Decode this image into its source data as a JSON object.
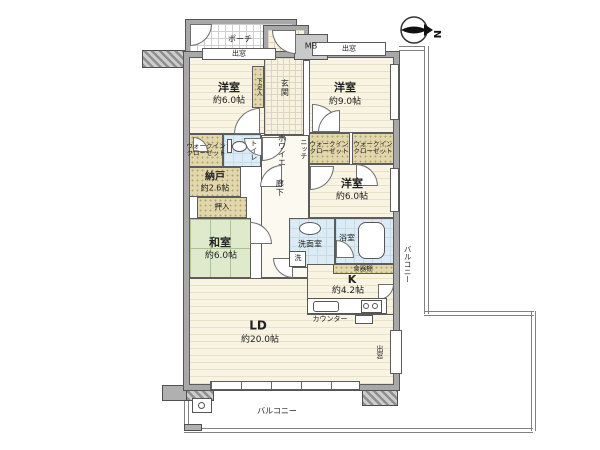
{
  "compass": {
    "north_label": "N"
  },
  "rooms": {
    "western_top_left": {
      "name": "洋室",
      "size": "約6.0帖"
    },
    "western_top_right": {
      "name": "洋室",
      "size": "約9.0帖"
    },
    "western_mid_right": {
      "name": "洋室",
      "size": "約6.0帖"
    },
    "japanese_room": {
      "name": "和室",
      "size": "約6.0帖"
    },
    "storage_room": {
      "name": "納戸",
      "size": "約2.6帖"
    },
    "living_dining": {
      "name": "LD",
      "size": "約20.0帖"
    },
    "kitchen": {
      "name": "K",
      "size": "約4.2帖"
    }
  },
  "labels": {
    "porch": "ポーチ",
    "entrance": "玄関",
    "shoe_cabinet": "下足入",
    "meter_box": "MB",
    "bay_window": "出窓",
    "foyer": "ホワイエ",
    "hallway": "廊下",
    "niche": "ニッチ",
    "walk_in_closet_line1": "ウォークイン",
    "walk_in_closet_line2": "クローゼット",
    "futon_closet": "押入",
    "toilet": "トイレ",
    "washroom": "洗面室",
    "washing_machine": "洗",
    "bathroom": "浴室",
    "cupboard": "食器棚",
    "counter": "カウンター",
    "balcony": "バルコニー"
  },
  "colors": {
    "wall": "#a8a8a8",
    "wall_edge": "#555555",
    "wood_floor": "#f8f3e2",
    "tatami": "#dfeacc",
    "closet": "#e2d7ac",
    "wet_area": "#ddecf4",
    "balcony_line": "#828282"
  }
}
